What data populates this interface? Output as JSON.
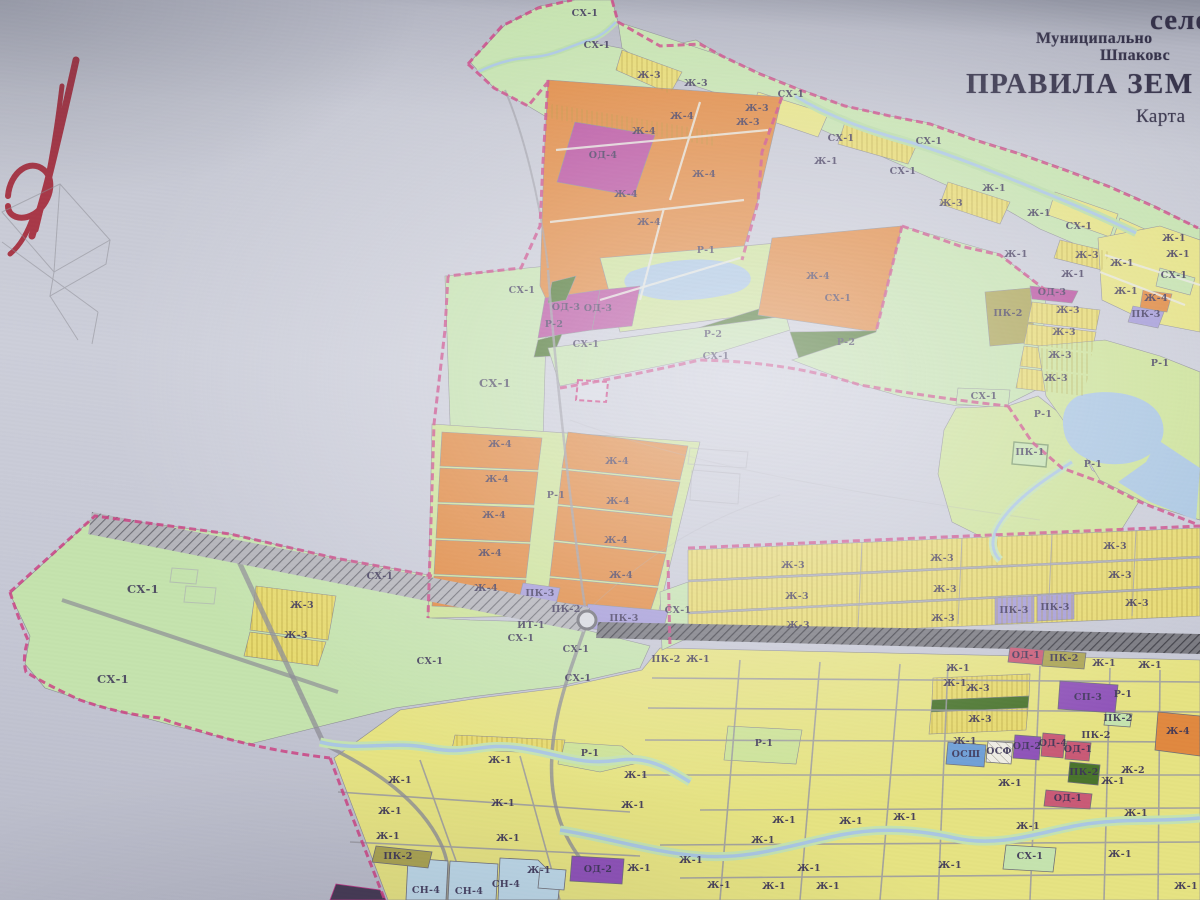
{
  "title": {
    "line1": "село",
    "line2": "Муниципально",
    "line3": "Шпаковс",
    "line4": "ПРАВИЛА ЗЕМ",
    "line5": "Карта"
  },
  "zone_colors": {
    "sx": "#c5e3ae",
    "r1": "#cde398",
    "zh1": "#e6e383",
    "zh3": "#e7da6e",
    "zh4": "#e0883f",
    "od": "#b84f9e",
    "od1": "#c95a76",
    "pk2": "#aaa352",
    "pk3": "#a49bd8",
    "sp3": "#8e52b8",
    "r2": "#49742c",
    "water": "#a9c6e2",
    "sn4": "#bdd8e8",
    "osh": "#6d9ed6",
    "boundary": "#cb4384",
    "label_ink": "#3c3557",
    "title_ink": "#343149",
    "sketch_red": "#a83848"
  },
  "map": {
    "labels": [
      {
        "t": "СХ-1",
        "x": 585,
        "y": 16
      },
      {
        "t": "СХ-1",
        "x": 597,
        "y": 48
      },
      {
        "t": "Ж-3",
        "x": 649,
        "y": 78
      },
      {
        "t": "Ж-3",
        "x": 696,
        "y": 86
      },
      {
        "t": "Ж-3",
        "x": 757,
        "y": 111
      },
      {
        "t": "Ж-3",
        "x": 748,
        "y": 125
      },
      {
        "t": "СХ-1",
        "x": 791,
        "y": 97
      },
      {
        "t": "СХ-1",
        "x": 841,
        "y": 141
      },
      {
        "t": "СХ-1",
        "x": 929,
        "y": 144
      },
      {
        "t": "Ж-1",
        "x": 826,
        "y": 164
      },
      {
        "t": "СХ-1",
        "x": 903,
        "y": 174
      },
      {
        "t": "Ж-3",
        "x": 951,
        "y": 206
      },
      {
        "t": "Ж-1",
        "x": 994,
        "y": 191
      },
      {
        "t": "Ж-1",
        "x": 1039,
        "y": 216
      },
      {
        "t": "СХ-1",
        "x": 1079,
        "y": 229
      },
      {
        "t": "Ж-1",
        "x": 1016,
        "y": 257
      },
      {
        "t": "Ж-3",
        "x": 1087,
        "y": 258
      },
      {
        "t": "Ж-1",
        "x": 1122,
        "y": 266
      },
      {
        "t": "Ж-1",
        "x": 1174,
        "y": 241
      },
      {
        "t": "Ж-1",
        "x": 1178,
        "y": 257
      },
      {
        "t": "СХ-1",
        "x": 1174,
        "y": 278
      },
      {
        "t": "Ж-1",
        "x": 1073,
        "y": 277
      },
      {
        "t": "Ж-1",
        "x": 1126,
        "y": 294
      },
      {
        "t": "Ж-4",
        "x": 1156,
        "y": 301
      },
      {
        "t": "ПК-3",
        "x": 1146,
        "y": 317
      },
      {
        "t": "Ж-4",
        "x": 682,
        "y": 119
      },
      {
        "t": "Ж-4",
        "x": 644,
        "y": 134
      },
      {
        "t": "ОД-4",
        "x": 603,
        "y": 158
      },
      {
        "t": "Ж-4",
        "x": 704,
        "y": 177
      },
      {
        "t": "Ж-4",
        "x": 626,
        "y": 197
      },
      {
        "t": "Ж-4",
        "x": 649,
        "y": 225
      },
      {
        "t": "СХ-1",
        "x": 522,
        "y": 293
      },
      {
        "t": "Р-1",
        "x": 706,
        "y": 253
      },
      {
        "t": "ОД-3",
        "x": 566,
        "y": 310
      },
      {
        "t": "ОД-3",
        "x": 598,
        "y": 311
      },
      {
        "t": "Р-2",
        "x": 554,
        "y": 327
      },
      {
        "t": "Р-2",
        "x": 713,
        "y": 337
      },
      {
        "t": "СХ-1",
        "x": 586,
        "y": 347
      },
      {
        "t": "СХ-1",
        "x": 716,
        "y": 359
      },
      {
        "t": "СХ-1",
        "x": 495,
        "y": 387,
        "s": 1
      },
      {
        "t": "Ж-4",
        "x": 818,
        "y": 279
      },
      {
        "t": "Р-2",
        "x": 846,
        "y": 345
      },
      {
        "t": "СХ-1",
        "x": 838,
        "y": 301
      },
      {
        "t": "ПК-2",
        "x": 1008,
        "y": 316
      },
      {
        "t": "ОД-3",
        "x": 1052,
        "y": 295
      },
      {
        "t": "Ж-3",
        "x": 1068,
        "y": 313
      },
      {
        "t": "Ж-3",
        "x": 1064,
        "y": 335
      },
      {
        "t": "Ж-3",
        "x": 1060,
        "y": 358
      },
      {
        "t": "Ж-3",
        "x": 1056,
        "y": 381
      },
      {
        "t": "СХ-1",
        "x": 984,
        "y": 399
      },
      {
        "t": "Р-1",
        "x": 1160,
        "y": 366
      },
      {
        "t": "Р-1",
        "x": 1043,
        "y": 417
      },
      {
        "t": "ПК-1",
        "x": 1030,
        "y": 455
      },
      {
        "t": "Р-1",
        "x": 1093,
        "y": 467
      },
      {
        "t": "Ж-4",
        "x": 500,
        "y": 447
      },
      {
        "t": "Ж-4",
        "x": 497,
        "y": 482
      },
      {
        "t": "Ж-4",
        "x": 494,
        "y": 518
      },
      {
        "t": "Ж-4",
        "x": 490,
        "y": 556
      },
      {
        "t": "Ж-4",
        "x": 486,
        "y": 591
      },
      {
        "t": "Р-1",
        "x": 556,
        "y": 498
      },
      {
        "t": "Ж-4",
        "x": 617,
        "y": 464
      },
      {
        "t": "Ж-4",
        "x": 618,
        "y": 504
      },
      {
        "t": "Ж-4",
        "x": 616,
        "y": 543
      },
      {
        "t": "Ж-4",
        "x": 621,
        "y": 578
      },
      {
        "t": "ПК-3",
        "x": 540,
        "y": 596
      },
      {
        "t": "ПК-2",
        "x": 566,
        "y": 612
      },
      {
        "t": "ПК-3",
        "x": 624,
        "y": 621
      },
      {
        "t": "ИТ-1",
        "x": 531,
        "y": 628
      },
      {
        "t": "СХ-1",
        "x": 678,
        "y": 613
      },
      {
        "t": "ПК-2",
        "x": 666,
        "y": 662
      },
      {
        "t": "Ж-1",
        "x": 698,
        "y": 662
      },
      {
        "t": "СХ-1",
        "x": 143,
        "y": 593,
        "s": 1
      },
      {
        "t": "СХ-1",
        "x": 113,
        "y": 683,
        "s": 1
      },
      {
        "t": "Ж-3",
        "x": 302,
        "y": 608
      },
      {
        "t": "Ж-3",
        "x": 296,
        "y": 638
      },
      {
        "t": "СХ-1",
        "x": 380,
        "y": 579
      },
      {
        "t": "СХ-1",
        "x": 430,
        "y": 664
      },
      {
        "t": "СХ-1",
        "x": 521,
        "y": 641
      },
      {
        "t": "СХ-1",
        "x": 576,
        "y": 652
      },
      {
        "t": "СХ-1",
        "x": 578,
        "y": 681
      },
      {
        "t": "Ж-3",
        "x": 793,
        "y": 568
      },
      {
        "t": "Ж-3",
        "x": 942,
        "y": 561
      },
      {
        "t": "Ж-3",
        "x": 1115,
        "y": 549
      },
      {
        "t": "Ж-3",
        "x": 797,
        "y": 599
      },
      {
        "t": "Ж-3",
        "x": 945,
        "y": 592
      },
      {
        "t": "Ж-3",
        "x": 1120,
        "y": 578
      },
      {
        "t": "Ж-3",
        "x": 798,
        "y": 628
      },
      {
        "t": "Ж-3",
        "x": 943,
        "y": 621
      },
      {
        "t": "ПК-3",
        "x": 1014,
        "y": 613
      },
      {
        "t": "ПК-3",
        "x": 1055,
        "y": 610
      },
      {
        "t": "Ж-3",
        "x": 1137,
        "y": 606
      },
      {
        "t": "Ж-1",
        "x": 958,
        "y": 671
      },
      {
        "t": "Ж-1",
        "x": 955,
        "y": 686
      },
      {
        "t": "Ж-3",
        "x": 978,
        "y": 691
      },
      {
        "t": "Ж-3",
        "x": 980,
        "y": 722
      },
      {
        "t": "Ж-1",
        "x": 965,
        "y": 744
      },
      {
        "t": "ОД-1",
        "x": 1026,
        "y": 658
      },
      {
        "t": "ПК-2",
        "x": 1064,
        "y": 661
      },
      {
        "t": "Ж-1",
        "x": 1104,
        "y": 666
      },
      {
        "t": "Ж-1",
        "x": 1150,
        "y": 668
      },
      {
        "t": "СП-3",
        "x": 1088,
        "y": 700
      },
      {
        "t": "Р-1",
        "x": 1123,
        "y": 697
      },
      {
        "t": "ПК-2",
        "x": 1118,
        "y": 721
      },
      {
        "t": "ПК-2",
        "x": 1096,
        "y": 738
      },
      {
        "t": "ОД-1",
        "x": 1078,
        "y": 752
      },
      {
        "t": "ОСШ",
        "x": 966,
        "y": 757
      },
      {
        "t": "ОСФ",
        "x": 999,
        "y": 754
      },
      {
        "t": "ОД-2",
        "x": 1027,
        "y": 749
      },
      {
        "t": "ОД-4",
        "x": 1053,
        "y": 746
      },
      {
        "t": "ПК-2",
        "x": 1084,
        "y": 775
      },
      {
        "t": "ОД-1",
        "x": 1068,
        "y": 801
      },
      {
        "t": "Ж-1",
        "x": 1010,
        "y": 786
      },
      {
        "t": "Ж-1",
        "x": 1028,
        "y": 829
      },
      {
        "t": "Ж-2",
        "x": 1133,
        "y": 773
      },
      {
        "t": "Ж-1",
        "x": 1113,
        "y": 784
      },
      {
        "t": "Ж-4",
        "x": 1178,
        "y": 734
      },
      {
        "t": "Ж-1",
        "x": 500,
        "y": 763
      },
      {
        "t": "Р-1",
        "x": 590,
        "y": 756
      },
      {
        "t": "Ж-1",
        "x": 400,
        "y": 783
      },
      {
        "t": "Ж-1",
        "x": 636,
        "y": 778
      },
      {
        "t": "Ж-1",
        "x": 503,
        "y": 806
      },
      {
        "t": "Ж-1",
        "x": 390,
        "y": 814
      },
      {
        "t": "Ж-1",
        "x": 633,
        "y": 808
      },
      {
        "t": "Ж-1",
        "x": 388,
        "y": 839
      },
      {
        "t": "Ж-1",
        "x": 508,
        "y": 841
      },
      {
        "t": "ПК-2",
        "x": 398,
        "y": 859
      },
      {
        "t": "Ж-1",
        "x": 539,
        "y": 873
      },
      {
        "t": "СН-4",
        "x": 426,
        "y": 893
      },
      {
        "t": "СН-4",
        "x": 469,
        "y": 894
      },
      {
        "t": "СН-4",
        "x": 506,
        "y": 887
      },
      {
        "t": "ОД-2",
        "x": 598,
        "y": 872
      },
      {
        "t": "Р-1",
        "x": 764,
        "y": 746
      },
      {
        "t": "Ж-1",
        "x": 784,
        "y": 823
      },
      {
        "t": "Ж-1",
        "x": 851,
        "y": 824
      },
      {
        "t": "Ж-1",
        "x": 763,
        "y": 843
      },
      {
        "t": "Ж-1",
        "x": 691,
        "y": 863
      },
      {
        "t": "Ж-1",
        "x": 639,
        "y": 871
      },
      {
        "t": "Ж-1",
        "x": 809,
        "y": 871
      },
      {
        "t": "Ж-1",
        "x": 719,
        "y": 888
      },
      {
        "t": "Ж-1",
        "x": 774,
        "y": 889
      },
      {
        "t": "Ж-1",
        "x": 828,
        "y": 889
      },
      {
        "t": "Ж-1",
        "x": 905,
        "y": 820
      },
      {
        "t": "Ж-1",
        "x": 1136,
        "y": 816
      },
      {
        "t": "СХ-1",
        "x": 1030,
        "y": 859
      },
      {
        "t": "Ж-1",
        "x": 1120,
        "y": 857
      },
      {
        "t": "Ж-1",
        "x": 1186,
        "y": 889
      },
      {
        "t": "Ж-1",
        "x": 950,
        "y": 868
      }
    ]
  }
}
